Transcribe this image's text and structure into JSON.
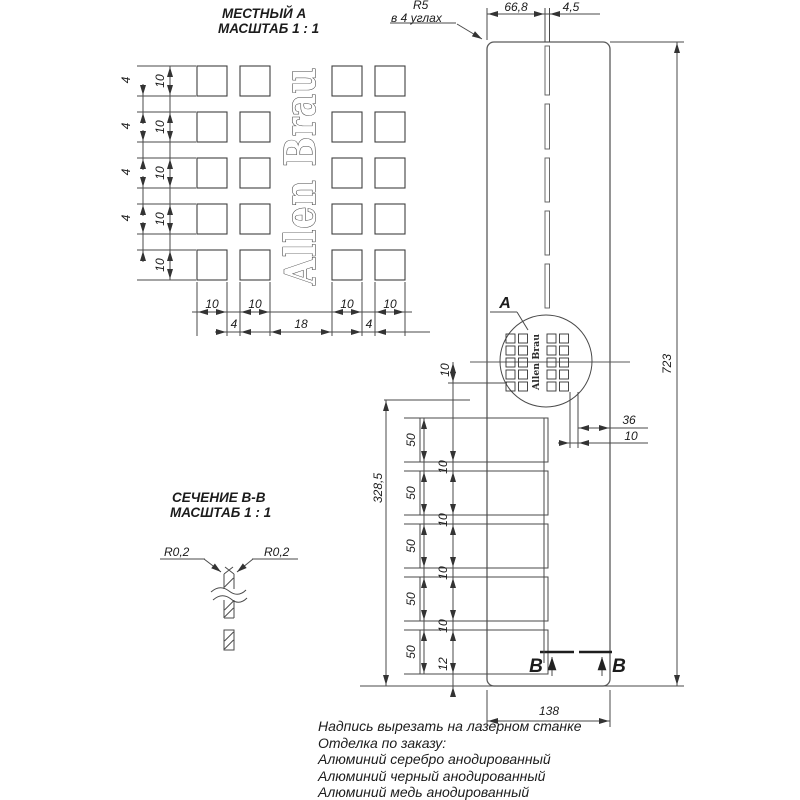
{
  "local_view": {
    "title": "МЕСТНЫЙ А",
    "scale": "МАСШТАБ 1 : 1",
    "row_dims": [
      "10",
      "10",
      "10",
      "10",
      "10"
    ],
    "row_gap_dims": [
      "4",
      "4",
      "4",
      "4"
    ],
    "col_dims": [
      "10",
      "10",
      "10",
      "10"
    ],
    "col_gap_dims": [
      "4",
      "18",
      "4"
    ]
  },
  "logo": {
    "text": "Allen Brau"
  },
  "panel": {
    "detail_label": "A",
    "corner_note": {
      "radius": "R5",
      "location": "в 4 углах"
    },
    "section_marks": [
      "В",
      "В"
    ],
    "dims": {
      "top_width": "66,8",
      "slot_width": "4,5",
      "height": "723",
      "width": "138",
      "logo_offset": "36",
      "logo_inset": "10",
      "logo_row": "10",
      "slots_span": "328,5",
      "slot_heights": [
        "50",
        "50",
        "50",
        "50",
        "50"
      ],
      "slot_gaps": [
        "10",
        "10",
        "10",
        "10"
      ],
      "bottom_gap": "12"
    }
  },
  "section_view": {
    "title": "СЕЧЕНИЕ В-В",
    "scale": "МАСШТАБ 1 : 1",
    "radii": [
      "R0,2",
      "R0,2"
    ]
  },
  "notes": [
    "Надпись вырезать на лазерном станке",
    "Отделка по заказу:",
    "Алюминий серебро анодированный",
    "Алюминий черный анодированный",
    "Алюминий медь анодированный"
  ],
  "colors": {
    "line": "#4a4a4a",
    "text": "#1c1c1c",
    "background": "#ffffff"
  }
}
